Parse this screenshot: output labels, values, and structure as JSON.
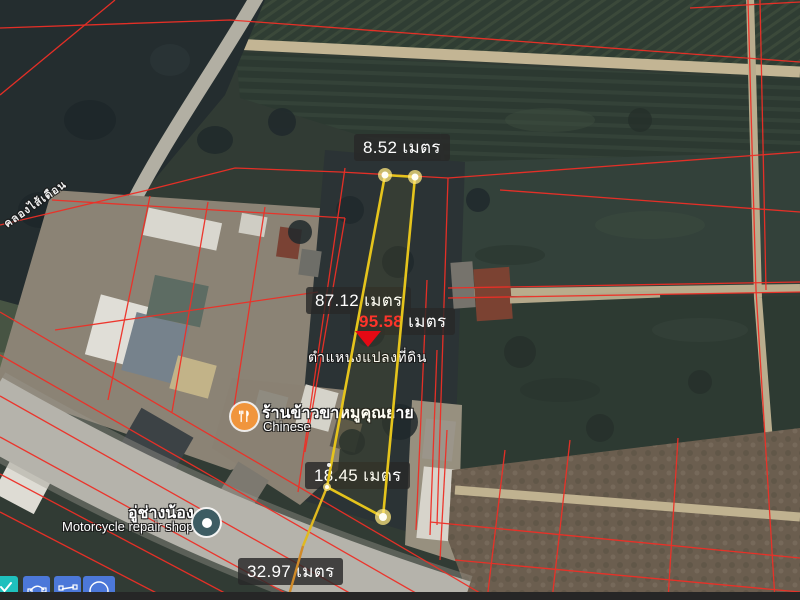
{
  "map": {
    "canal_label": "คลองไส้เดือน",
    "plot_location_label": "ตำแหน่งแปลงที่ดิน",
    "unit": "เมตร",
    "measurements": {
      "top_edge": "8.52",
      "left_edge": "87.12",
      "right_edge": "95.58",
      "bottom_edge": "18.45",
      "road_segment": "32.97"
    },
    "pois": {
      "restaurant": {
        "title": "ร้านข้าวขาหมูคุณยาย",
        "subtitle": "Chinese"
      },
      "repair_shop": {
        "title": "อู่ช่างน้อง",
        "subtitle": "Motorcycle repair shop"
      }
    },
    "colors": {
      "measurement_line": "#E5C41C",
      "measurement_vertex": "#FFE87D",
      "parcel_boundary": "#EE2F26",
      "highlight_value": "#FF2A2A",
      "location_marker": "#E50914",
      "restaurant_pin": "#F0953C",
      "repair_shop_pin": "#3D5C63",
      "toolbar_teal": "#1FC0BD",
      "toolbar_blue": "#4C78D9"
    }
  },
  "toolbar": {
    "buttons": [
      {
        "name": "confirm-tool",
        "icon": "check-icon"
      },
      {
        "name": "curve-tool",
        "icon": "curve-nodes-icon"
      },
      {
        "name": "line-tool",
        "icon": "line-segment-icon"
      },
      {
        "name": "circle-tool",
        "icon": "circle-icon"
      }
    ]
  }
}
